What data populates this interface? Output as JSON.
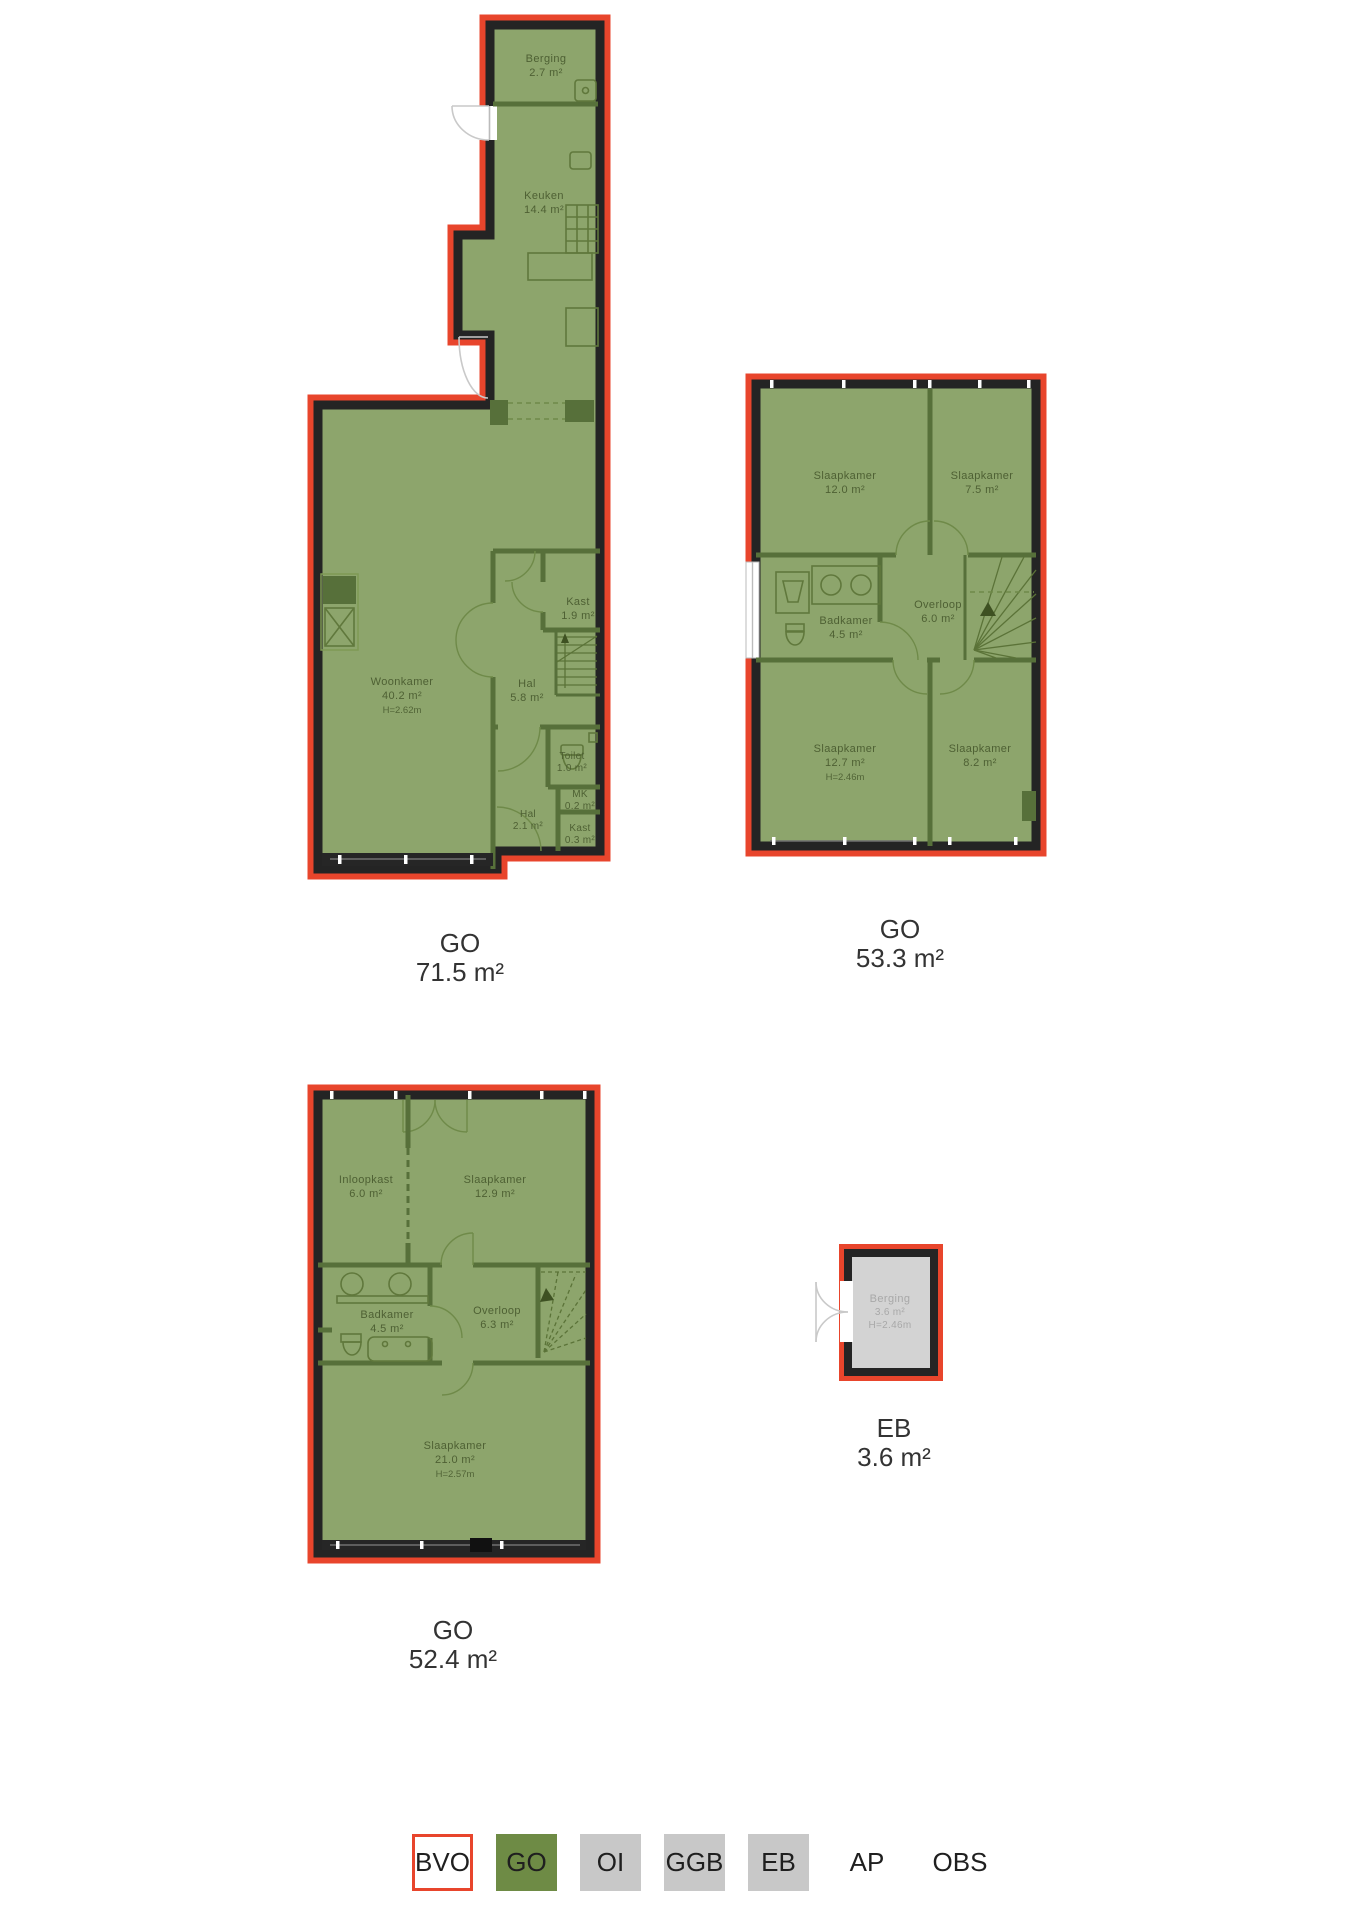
{
  "plans": [
    {
      "code": "GO",
      "total_area": "71.5 m²",
      "rooms": [
        {
          "name": "Berging",
          "area": "2.7 m²"
        },
        {
          "name": "Keuken",
          "area": "14.4 m²"
        },
        {
          "name": "Woonkamer",
          "area": "40.2 m²",
          "height": "H=2.62m"
        },
        {
          "name": "Kast",
          "area": "1.9 m²"
        },
        {
          "name": "Hal",
          "area": "5.8 m²"
        },
        {
          "name": "Toilet",
          "area": "1.0 m²"
        },
        {
          "name": "MK",
          "area": "0.2 m²"
        },
        {
          "name": "Hal",
          "area": "2.1 m²"
        },
        {
          "name": "Kast",
          "area": "0.3 m²"
        }
      ]
    },
    {
      "code": "GO",
      "total_area": "53.3 m²",
      "rooms": [
        {
          "name": "Slaapkamer",
          "area": "12.0 m²"
        },
        {
          "name": "Slaapkamer",
          "area": "7.5 m²"
        },
        {
          "name": "Badkamer",
          "area": "4.5 m²"
        },
        {
          "name": "Overloop",
          "area": "6.0 m²"
        },
        {
          "name": "Slaapkamer",
          "area": "12.7 m²",
          "height": "H=2.46m"
        },
        {
          "name": "Slaapkamer",
          "area": "8.2 m²"
        }
      ]
    },
    {
      "code": "GO",
      "total_area": "52.4 m²",
      "rooms": [
        {
          "name": "Inloopkast",
          "area": "6.0 m²"
        },
        {
          "name": "Slaapkamer",
          "area": "12.9 m²"
        },
        {
          "name": "Badkamer",
          "area": "4.5 m²"
        },
        {
          "name": "Overloop",
          "area": "6.3 m²"
        },
        {
          "name": "Slaapkamer",
          "area": "21.0 m²",
          "height": "H=2.57m"
        }
      ]
    },
    {
      "code": "EB",
      "total_area": "3.6 m²",
      "rooms": [
        {
          "name": "Berging",
          "area": "3.6 m²",
          "height": "H=2.46m"
        }
      ]
    }
  ],
  "legend": {
    "items": [
      {
        "label": "BVO"
      },
      {
        "label": "GO"
      },
      {
        "label": "OI"
      },
      {
        "label": "GGB"
      },
      {
        "label": "EB"
      },
      {
        "label": "AP"
      },
      {
        "label": "OBS"
      }
    ]
  },
  "colors": {
    "outline_red": "#E8452C",
    "plan_green": "#8DA56C",
    "legend_green": "#6E8B45",
    "legend_gray": "#C8C8C8",
    "wall_black": "#242424",
    "eb_gray": "#D3D3D3"
  }
}
